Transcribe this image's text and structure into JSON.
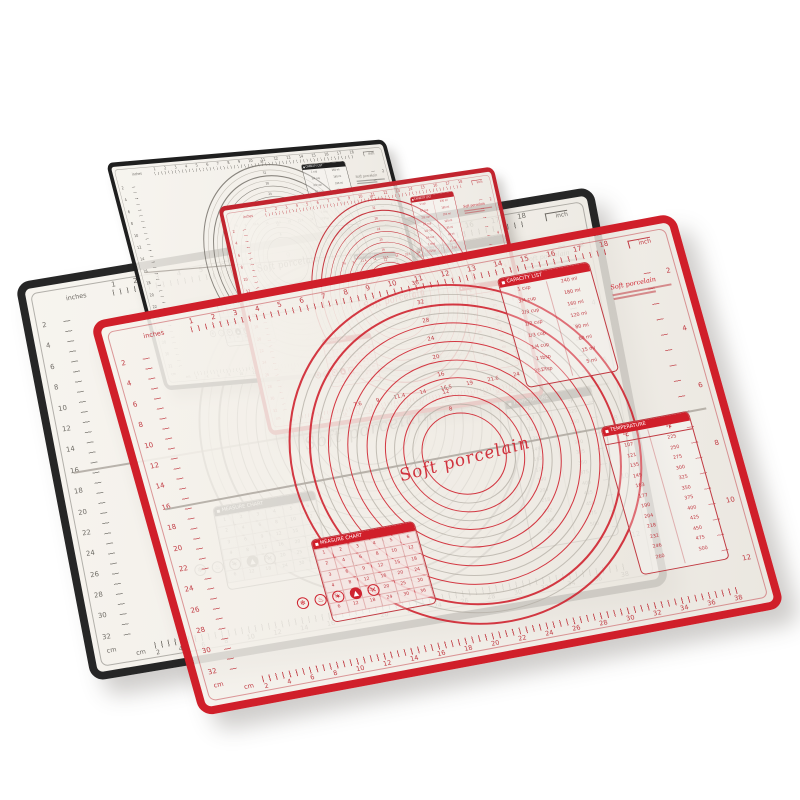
{
  "product": {
    "description": "overlapping silicone pastry baking mats product photo",
    "script_text": "Soft porcelain",
    "background_color": "#ffffff"
  },
  "mats": [
    {
      "name": "mat-back-black",
      "color_name": "black",
      "accent": "#262626",
      "ink": "#6e6b65",
      "ring": "#85817a"
    },
    {
      "name": "mat-upper-black",
      "color_name": "black",
      "accent": "#1f1f1f",
      "ink": "#66635e",
      "ring": "#7d7972"
    },
    {
      "name": "mat-small-red",
      "color_name": "red",
      "accent": "#c2242e",
      "ink": "#c4454d",
      "ring": "#c2242e"
    },
    {
      "name": "mat-large-red",
      "color_name": "red",
      "accent": "#d01f2a",
      "ink": "#c13a42",
      "ring": "#cf2430"
    }
  ],
  "rulers": {
    "top": {
      "label": "inches",
      "corner_label": "inch",
      "numbers": [
        1,
        2,
        3,
        4,
        5,
        6,
        7,
        8,
        9,
        10,
        11,
        12,
        13,
        14,
        15,
        16,
        17,
        18
      ]
    },
    "left": {
      "label": "cm",
      "numbers": [
        2,
        4,
        6,
        8,
        10,
        12,
        14,
        16,
        18,
        20,
        22,
        24,
        26,
        28,
        30,
        32
      ]
    },
    "right": {
      "label": "inch",
      "numbers": [
        2,
        4,
        6,
        8,
        10,
        12
      ]
    },
    "bottom": {
      "label": "cm",
      "numbers": [
        2,
        4,
        6,
        8,
        10,
        12,
        14,
        16,
        18,
        20,
        22,
        24,
        26,
        28,
        30,
        32,
        34,
        36,
        38
      ]
    }
  },
  "circle_panel": {
    "script_text": "Soft porcelain",
    "ring_labels": [
      "36",
      "32",
      "28",
      "24",
      "20",
      "16",
      "12",
      "8"
    ],
    "diameter_scale": [
      "7.6",
      "9",
      "11.4",
      "14",
      "16.5",
      "19",
      "21.6",
      "24",
      "26.7"
    ]
  },
  "tables": {
    "capacity": {
      "title": "CAPACITY LIST",
      "rows": [
        [
          "1 cup",
          "240 ml"
        ],
        [
          "3/4 cup",
          "180 ml"
        ],
        [
          "2/3 cup",
          "160 ml"
        ],
        [
          "1/2 cup",
          "120 ml"
        ],
        [
          "1/3 cup",
          "80 ml"
        ],
        [
          "1/4 cup",
          "60 ml"
        ],
        [
          "1 tbsp",
          "15 ml"
        ],
        [
          "1 tsp",
          "5 ml"
        ]
      ]
    },
    "temperature": {
      "title": "TEMPERATURE",
      "col_headers": [
        "°C",
        "°F"
      ],
      "rows": [
        [
          "107",
          "225"
        ],
        [
          "121",
          "250"
        ],
        [
          "135",
          "275"
        ],
        [
          "149",
          "300"
        ],
        [
          "163",
          "325"
        ],
        [
          "177",
          "350"
        ],
        [
          "190",
          "375"
        ],
        [
          "204",
          "400"
        ],
        [
          "218",
          "425"
        ],
        [
          "232",
          "450"
        ],
        [
          "246",
          "475"
        ],
        [
          "260",
          "500"
        ]
      ]
    },
    "size_grid": {
      "title": "MEASURE CHART",
      "rows": [
        [
          1,
          2,
          3,
          4,
          5,
          6
        ],
        [
          2,
          4,
          6,
          8,
          10,
          12
        ],
        [
          3,
          6,
          9,
          12,
          15,
          18
        ],
        [
          4,
          8,
          12,
          16,
          20,
          24
        ],
        [
          5,
          10,
          15,
          20,
          25,
          30
        ],
        [
          6,
          12,
          18,
          24,
          30,
          36
        ]
      ]
    }
  },
  "care_icons": [
    {
      "name": "snowflake-icon",
      "glyph": "❄",
      "filled": false
    },
    {
      "name": "heat-safe-icon",
      "glyph": "♨",
      "filled": false
    },
    {
      "name": "star-icon",
      "glyph": "✶",
      "filled": false
    },
    {
      "name": "flame-icon",
      "glyph": "▲",
      "filled": true
    },
    {
      "name": "no-cut-icon",
      "glyph": "✕",
      "filled": false
    }
  ]
}
